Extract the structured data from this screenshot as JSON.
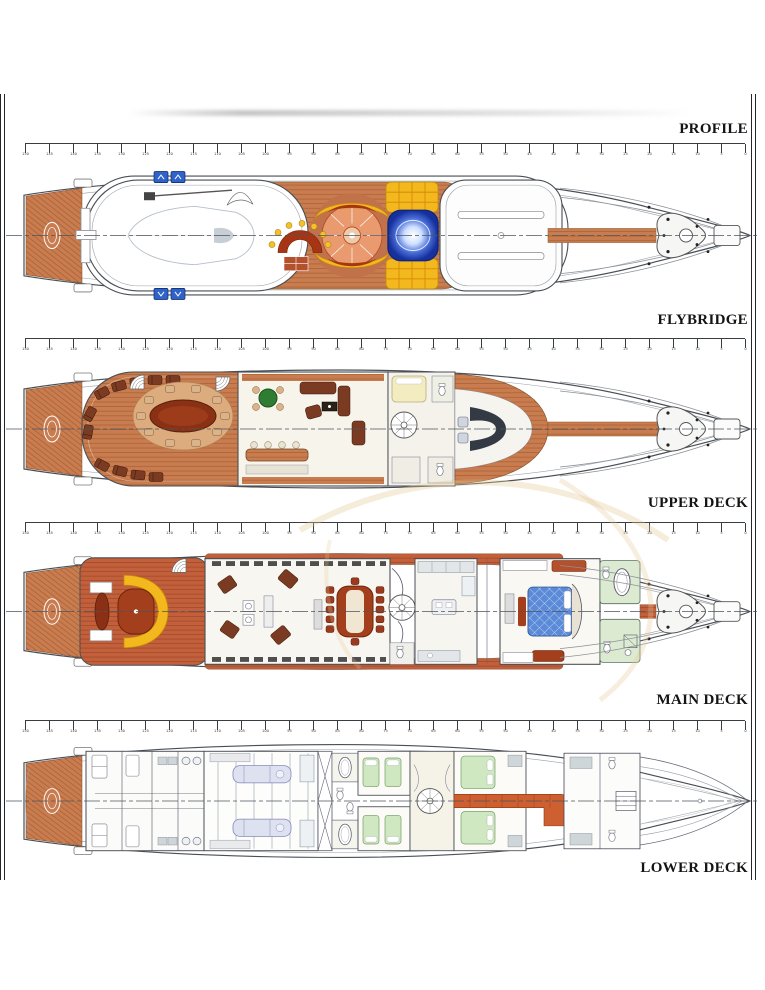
{
  "page": {
    "width": 765,
    "height": 990,
    "background": "#ffffff"
  },
  "deck_labels": [
    {
      "id": "profile",
      "label": "PROFILE"
    },
    {
      "id": "flybridge",
      "label": "FLYBRIDGE"
    },
    {
      "id": "upper-deck",
      "label": "UPPER DECK"
    },
    {
      "id": "main-deck",
      "label": "MAIN DECK"
    },
    {
      "id": "lower-deck",
      "label": "LOWER DECK"
    }
  ],
  "ruler": {
    "start": 150,
    "end": 0,
    "step": 5
  },
  "colors": {
    "paper": "#ffffff",
    "ink": "#141414",
    "line": "#4a4f55",
    "line_light": "#9aa1a8",
    "wood": "#c97c50",
    "wood_stripe": "#a5602f",
    "wood_red": "#c2603c",
    "wood_red_stripe": "#9e4525",
    "wood_pale": "#dcab7e",
    "corridor_orange": "#cd5f30",
    "yellow": "#f3b81d",
    "sunpad_red": "#a63415",
    "salmon": "#e99a6e",
    "spa_blue": "#16309e",
    "blue_box": "#2f63c9",
    "green_table": "#2e7d32",
    "bed_yellow": "#f3ecc0",
    "bed_blue": "#5b8bd8",
    "bed_green": "#cfe8c2",
    "sofa": "#7a3b22",
    "tile_green": "#dcead2",
    "stain": "#e3c896"
  }
}
